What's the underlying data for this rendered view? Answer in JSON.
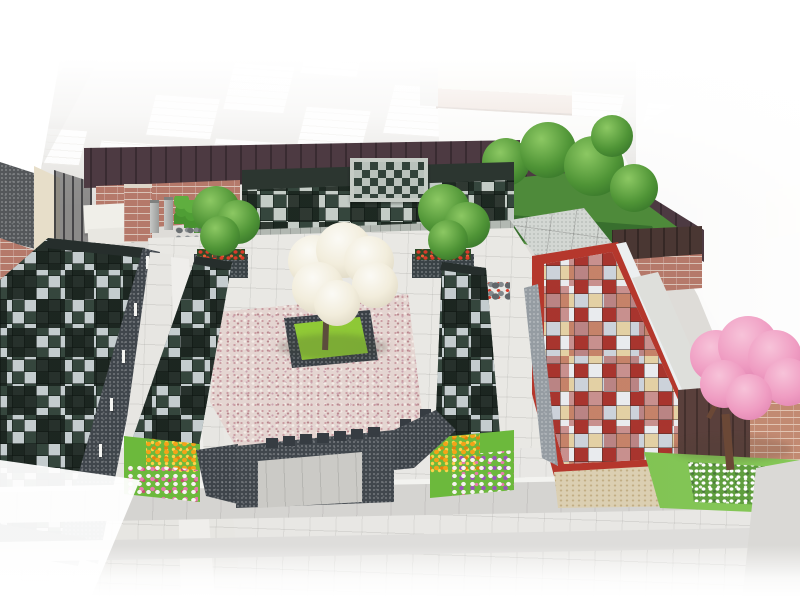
{
  "meta": {
    "title": "3D architectural rendering of a Japanese cemetery memorial garden (columbarium courtyard)",
    "image_type": "cg-perspective-render",
    "width_px": 800,
    "height_px": 600,
    "visible_text": "none"
  },
  "scene": {
    "background": {
      "parking-lot": "faded light-gray parking area with white striped stall rows, washed to white at top",
      "road-right": "pale gray road wedge on the right side fading to white",
      "road-marking": "pale yellow pavement marking patch at far right",
      "building-top-right": "faded beige low-rise building with tan base band",
      "building-left": "cream building corner with dark gravel roof and brick lower wall at far left"
    },
    "boundary": {
      "fence-main": "dark maroon panel fence along the back of the garden",
      "fence-right": "maroon fence running diagonally down the right boundary",
      "fence-corner": "dark brown fence corner panel with brick base",
      "metal-fence-left": "dark metal mesh fence beside the left building",
      "white-wall-right": "low white boundary wall behind the red columbarium",
      "maroon-wall-right": "dark maroon wall behind the cherry tree",
      "brick-wall-right": "light brick wall at far right behind the cherry tree"
    },
    "memorials": {
      "back-columbarium": "long sloped columbarium wall at the rear with dark-green and light granite plaque checkerboard and a central granite-framed monument",
      "left-columbarium": "large sloped checkerboard columbarium field along the left edge with white railing posts",
      "left-strip-columbarium": "narrow sloped checkered columbarium row left of the central gravel garden",
      "right-strip-columbarium": "narrow sloped checkered columbarium row right of the central gravel garden",
      "red-columbarium": "long low columbarium with bright red frame and multicolor (red/cream/gray/white) plaque checkerboard top, granite end cap and beige stone base",
      "front-wall": "dark speckled granite enclosure wall with small crenellation blocks and a recessed light-gray central entrance"
    },
    "garden": {
      "gravel-field": "central field of pink and white decorative gravel",
      "grass-plot": "bright green square lawn with dark granite curb at the center",
      "dogwood-tree": "white-blossoming tree planted in the central lawn square",
      "planter-trees": "two green trees in dark stone planters edged with red flowers flanking the courtyard",
      "topiary-row": "row of small stacked-ball topiary trees near the entrance",
      "entrance-monument": "white stone monument slabs and brick gate pillar with two gray stone pillars",
      "flower-bed-left": "flower bed with orange marigolds and white-pink flowers",
      "flower-bed-right": "flower bed with orange marigolds and white-violet flowers",
      "right-garden": "enclosed green garden with trees and clipped hedge at the upper right",
      "cherry-tree": "pink cherry blossom tree on a lawn at the lower right",
      "white-shrub-bed": "bed of white flowering shrubs under the cherry tree",
      "rock-clusters": "small decorative rock groupings with accent flowers"
    },
    "hardscape": {
      "courtyard-pavement": "light granite tile pavement inside the garden",
      "plaza-pavement": "broad light-gray tiled plaza in the foreground with darker joint bands",
      "left-walkway": "tiled walkway with lighter center band along the left columbarium"
    }
  },
  "palette": {
    "bg_road": "#dedcd8",
    "beige_bldg": "#e7dec9",
    "tan_band": "#c9a28c",
    "fence": "#4d3a42",
    "fence_brown": "#4a3733",
    "brick": "#b5796a",
    "brick_mortar": "#d9c2b6",
    "col_dark": "#35463d",
    "col_light": "#c9d0d2",
    "granite_base": "#b2b8b2",
    "granite_dark": "#40464c",
    "pave": "#e8e7e4",
    "pave_band": "#d5d4d1",
    "gravel_base": "#e4d5d1",
    "gravel_dot1": "#c99ca2",
    "gravel_dot2": "#b9888e",
    "grass_bright": "#6cb93c",
    "leaf_green": "#4f9436",
    "leaf_light": "#8cc863",
    "hedge": "#386f2e",
    "white_bloom": "#f2eddc",
    "bloom_shade": "#d9d2bc",
    "cherry": "#ef9cc2",
    "cherry_light": "#f7c3d9",
    "cherry_deep": "#de7fae",
    "trunk": "#5c4c3c",
    "red_frame": "#b5372c",
    "red_sq": "#a8352e",
    "cream_sq": "#e3d0a4",
    "gray_sq": "#ccd2da",
    "white_sq": "#e9ebee",
    "base_beige": "#dbcfb2",
    "maroon_wall": "#5a403c",
    "marigold": "#f4a318",
    "marigold_deep": "#e3830e",
    "pink_fl": "#e87ab0",
    "violet_fl": "#9a55b8",
    "white_fl": "#f6f4f0"
  }
}
